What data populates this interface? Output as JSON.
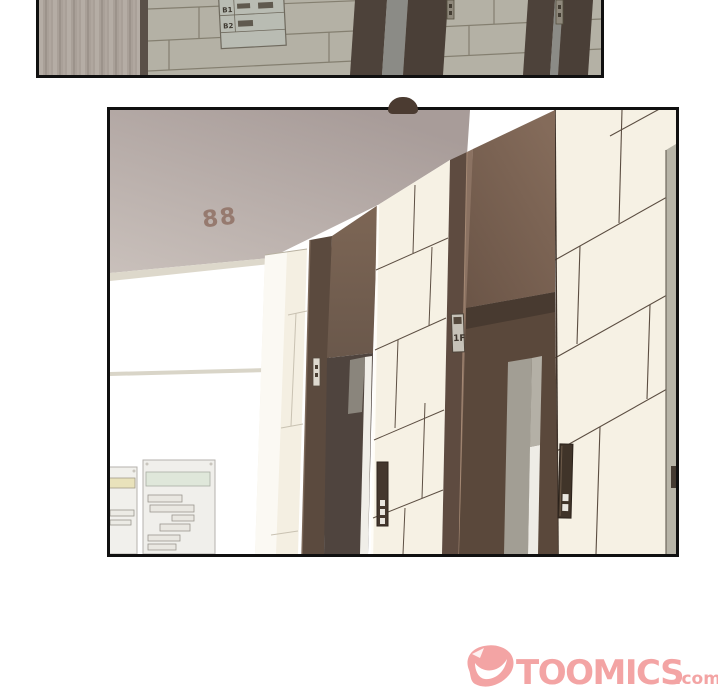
{
  "comic": {
    "top_panel": {
      "directory_sign": {
        "rows": [
          {
            "label": "B1"
          },
          {
            "label": "B2"
          }
        ]
      }
    },
    "main_panel": {
      "ceiling_marking": "88",
      "door_plate_label": "1F"
    }
  },
  "footer": {
    "brand": "TOOMICS",
    "suffix": ".com"
  },
  "colors": {
    "brand_pink": "#f3a4a4",
    "panel_border": "#101010",
    "ceiling_gray": "#b2a6a2",
    "tile_cream": "#f6f1e4",
    "door_brown": "#5e4b40",
    "top_tile_gray": "#b4b1a5",
    "ceiling_number_brown": "#93766a"
  }
}
